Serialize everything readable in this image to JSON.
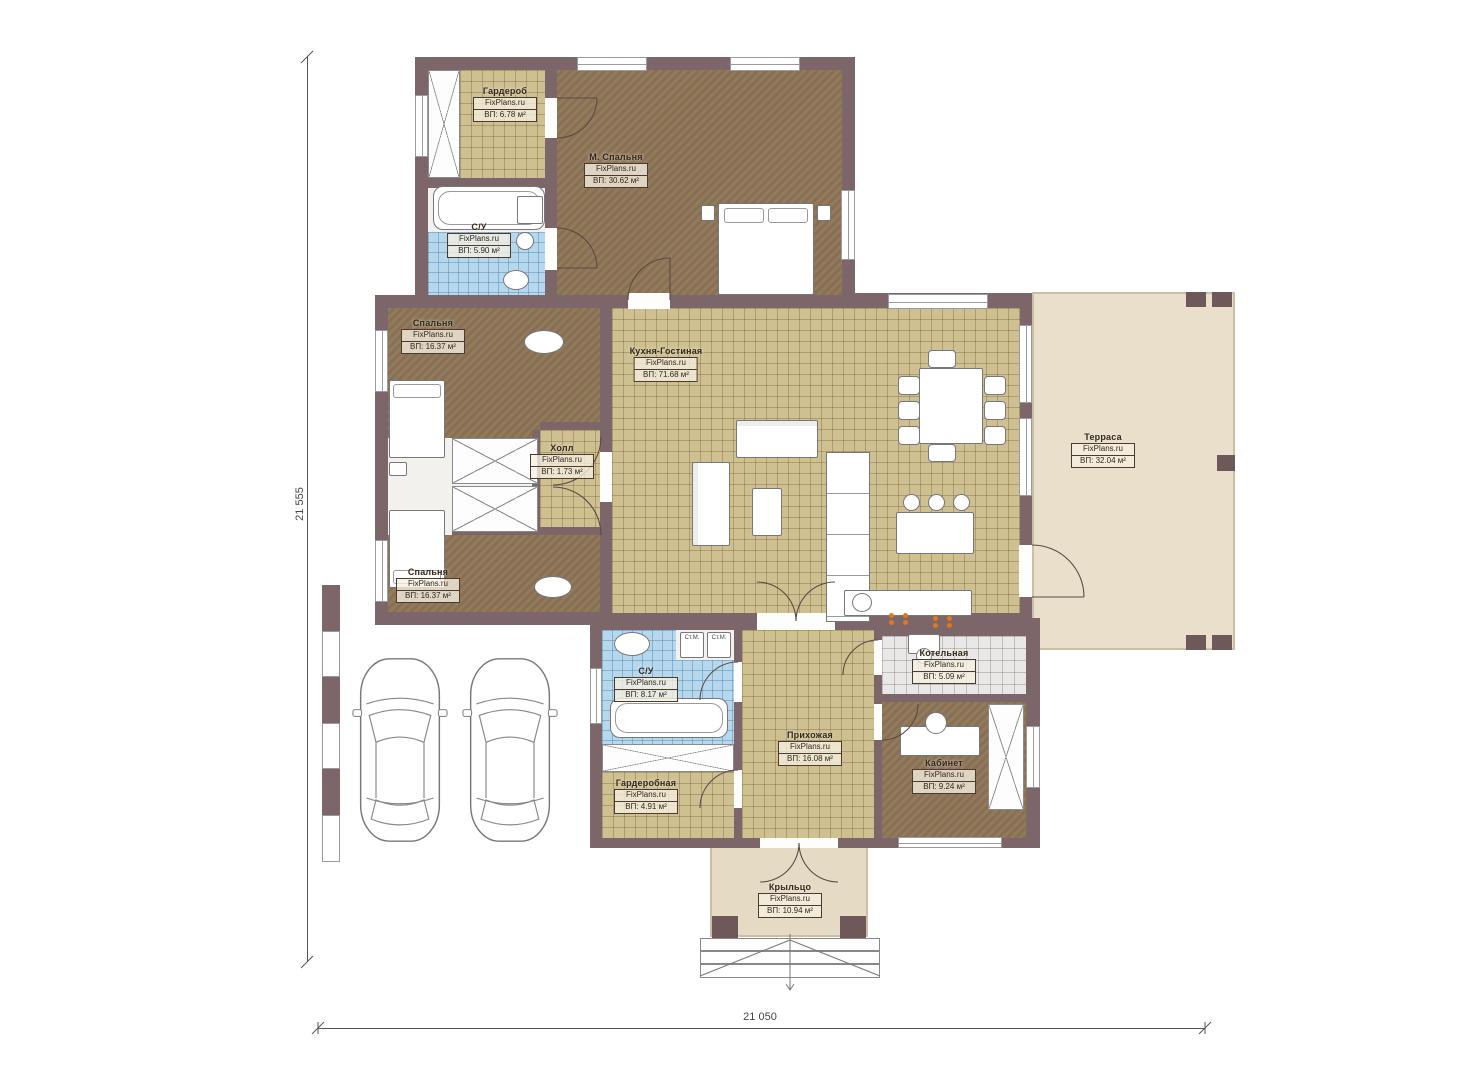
{
  "brand": "FixPlans.ru",
  "dimensions": {
    "left": "21 555",
    "bottom": "21 050"
  },
  "appliance_labels": {
    "washer": "Ст.М."
  },
  "rooms": [
    {
      "name": "Гардероб",
      "area": "ВП: 6.78 м²"
    },
    {
      "name": "М. Спальня",
      "area": "ВП: 30.62 м²"
    },
    {
      "name": "С/У",
      "area": "ВП: 5.90 м²"
    },
    {
      "name": "Спальня",
      "area": "ВП: 16.37 м²"
    },
    {
      "name": "Холл",
      "area": "ВП: 1.73 м²"
    },
    {
      "name": "Кухня-Гостиная",
      "area": "ВП: 71.68 м²"
    },
    {
      "name": "Терраса",
      "area": "ВП: 32.04 м²"
    },
    {
      "name": "Спальня",
      "area": "ВП: 16.37 м²"
    },
    {
      "name": "С/У",
      "area": "ВП: 8.17 м²"
    },
    {
      "name": "Прихожая",
      "area": "ВП: 16.08 м²"
    },
    {
      "name": "Котельная",
      "area": "ВП: 5.09 м²"
    },
    {
      "name": "Кабинет",
      "area": "ВП: 9.24 м²"
    },
    {
      "name": "Гардеробная",
      "area": "ВП: 4.91 м²"
    },
    {
      "name": "Крыльцо",
      "area": "ВП: 10.94 м²"
    }
  ],
  "colors": {
    "wall": "#7c6669",
    "floor_bedroom": "#8c7355",
    "floor_tile": "#cfc092",
    "floor_bath": "#b7d8ec",
    "floor_boiler": "#e9e8e6",
    "floor_terrace": "#e9dfca",
    "floor_porch": "#e5dbc5",
    "burner_accent": "#e2771e"
  }
}
